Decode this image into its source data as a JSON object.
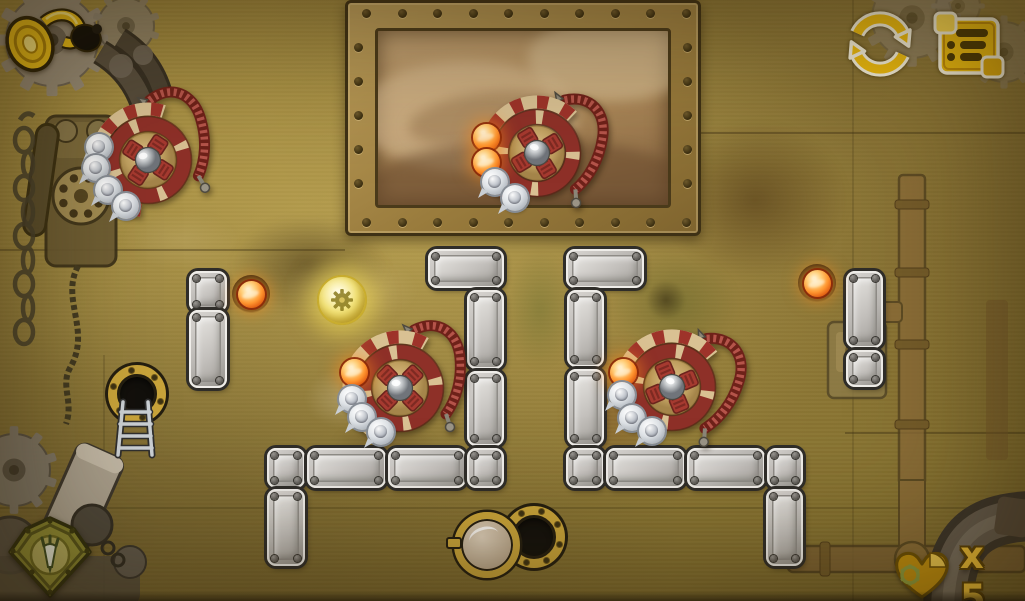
{
  "colors": {
    "background_olive": "#a08a3e",
    "ui_gold": "#eab90f",
    "outline_cream": "#f1ecd8",
    "wheel_red": "#9e332a",
    "wheel_cream": "#d9c193",
    "block_gray": "#c6c3bf",
    "fireball_orange": "#ff9630",
    "lives_text_gold": "#f2c237",
    "porthole_gold": "#c9a43a"
  },
  "hud": {
    "horn_button": {
      "icon": "horn-icon"
    },
    "restart_button": {
      "icon": "restart-arrows-icon"
    },
    "menu_button": {
      "icon": "menu-list-icon"
    },
    "rocket_badge": {
      "icon": "rocket-gem-icon"
    },
    "lives": {
      "icon": "heart-gear-icon",
      "label": "x 5"
    }
  },
  "board": {
    "window": {
      "x": 345,
      "y": 0,
      "w": 356,
      "h": 236
    },
    "blocks": [
      {
        "x": 189,
        "y": 271,
        "w": 38,
        "h": 41
      },
      {
        "x": 189,
        "y": 310,
        "w": 38,
        "h": 78
      },
      {
        "x": 428,
        "y": 249,
        "w": 76,
        "h": 39
      },
      {
        "x": 467,
        "y": 290,
        "w": 37,
        "h": 79
      },
      {
        "x": 467,
        "y": 371,
        "w": 37,
        "h": 75
      },
      {
        "x": 267,
        "y": 448,
        "w": 38,
        "h": 40
      },
      {
        "x": 307,
        "y": 448,
        "w": 79,
        "h": 40
      },
      {
        "x": 388,
        "y": 448,
        "w": 78,
        "h": 40
      },
      {
        "x": 467,
        "y": 448,
        "w": 37,
        "h": 40
      },
      {
        "x": 267,
        "y": 489,
        "w": 38,
        "h": 77
      },
      {
        "x": 566,
        "y": 249,
        "w": 78,
        "h": 39
      },
      {
        "x": 567,
        "y": 290,
        "w": 37,
        "h": 77
      },
      {
        "x": 567,
        "y": 369,
        "w": 37,
        "h": 77
      },
      {
        "x": 566,
        "y": 448,
        "w": 38,
        "h": 40
      },
      {
        "x": 606,
        "y": 448,
        "w": 79,
        "h": 40
      },
      {
        "x": 687,
        "y": 448,
        "w": 78,
        "h": 40
      },
      {
        "x": 767,
        "y": 448,
        "w": 36,
        "h": 40
      },
      {
        "x": 766,
        "y": 489,
        "w": 37,
        "h": 77
      },
      {
        "x": 846,
        "y": 271,
        "w": 37,
        "h": 77
      },
      {
        "x": 846,
        "y": 350,
        "w": 37,
        "h": 37
      }
    ],
    "wheels": [
      {
        "x": 148,
        "y": 160,
        "rot": -12,
        "glow": true,
        "bubbles": [
          {
            "t": "ball",
            "dx": -49,
            "dy": -13
          },
          {
            "t": "ball",
            "dx": -52,
            "dy": 8
          },
          {
            "t": "ball",
            "dx": -40,
            "dy": 30
          },
          {
            "t": "ball",
            "dx": -22,
            "dy": 46
          }
        ]
      },
      {
        "x": 537,
        "y": 153,
        "rot": 14,
        "glow": false,
        "bubbles": [
          {
            "t": "fire",
            "dx": -51,
            "dy": -16
          },
          {
            "t": "fire",
            "dx": -51,
            "dy": 9
          },
          {
            "t": "ball",
            "dx": -42,
            "dy": 29
          },
          {
            "t": "ball",
            "dx": -22,
            "dy": 45
          }
        ]
      },
      {
        "x": 400,
        "y": 388,
        "rot": 0,
        "glow": false,
        "bubbles": [
          {
            "t": "fire",
            "dx": -46,
            "dy": -16
          },
          {
            "t": "ball",
            "dx": -48,
            "dy": 11
          },
          {
            "t": "ball",
            "dx": -38,
            "dy": 29
          },
          {
            "t": "ball",
            "dx": -19,
            "dy": 44
          }
        ]
      },
      {
        "x": 672,
        "y": 387,
        "rot": 22,
        "glow": false,
        "bubbles": [
          {
            "t": "fire",
            "dx": -49,
            "dy": -15
          },
          {
            "t": "ball",
            "dx": -50,
            "dy": 8
          },
          {
            "t": "ball",
            "dx": -40,
            "dy": 31
          },
          {
            "t": "ball",
            "dx": -20,
            "dy": 44
          }
        ]
      }
    ],
    "loose_fireballs": [
      {
        "x": 251,
        "y": 294
      },
      {
        "x": 817,
        "y": 283
      }
    ],
    "powerup_orb": {
      "x": 340,
      "y": 298
    },
    "entry_hatch": {
      "x": 137,
      "y": 394
    },
    "ladder": {
      "x": 112,
      "y": 398
    },
    "exit_hatch": {
      "x": 534,
      "y": 537
    },
    "exit_lid": {
      "x": 480,
      "y": 538
    }
  }
}
